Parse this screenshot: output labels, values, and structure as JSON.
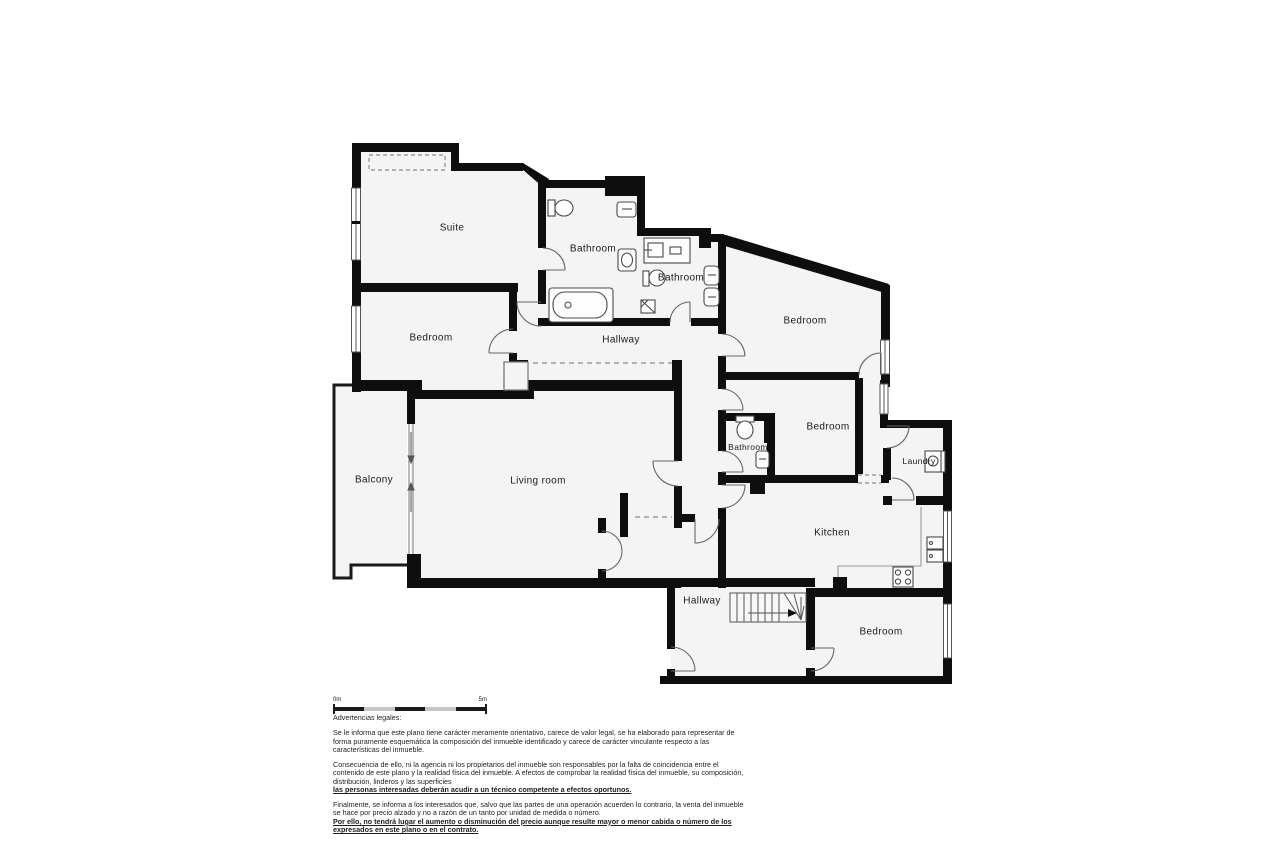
{
  "floorplan": {
    "rooms": [
      {
        "name": "suite",
        "label": "Suite",
        "x": 452,
        "y": 228
      },
      {
        "name": "bathroom-1",
        "label": "Bathroom",
        "x": 593,
        "y": 249
      },
      {
        "name": "bathroom-2",
        "label": "Bathroom",
        "x": 681,
        "y": 278
      },
      {
        "name": "bedroom-top-right",
        "label": "Bedroom",
        "x": 805,
        "y": 321
      },
      {
        "name": "hallway-upper",
        "label": "Hallway",
        "x": 621,
        "y": 340
      },
      {
        "name": "bedroom-left",
        "label": "Bedroom",
        "x": 431,
        "y": 338
      },
      {
        "name": "balcony",
        "label": "Balcony",
        "x": 374,
        "y": 480
      },
      {
        "name": "living-room",
        "label": "Living room",
        "x": 538,
        "y": 481
      },
      {
        "name": "bathroom-3",
        "label": "Bathroom",
        "x": 748,
        "y": 447
      },
      {
        "name": "bedroom-middle",
        "label": "Bedroom",
        "x": 828,
        "y": 427
      },
      {
        "name": "laundry",
        "label": "Laundry",
        "x": 919,
        "y": 461
      },
      {
        "name": "kitchen",
        "label": "Kitchen",
        "x": 832,
        "y": 533
      },
      {
        "name": "hallway-lower",
        "label": "Hallway",
        "x": 702,
        "y": 601
      },
      {
        "name": "bedroom-bottom",
        "label": "Bedroom",
        "x": 881,
        "y": 632
      }
    ],
    "scale_bar": {
      "start_label": "0m",
      "end_label": "5m"
    }
  },
  "legal": {
    "title": "Advertencias legales:",
    "p1": "Se le informa que este plano tiene carácter meramente orientativo, carece de valor legal, se ha elaborado para representar de forma puramente esquemática la composición del inmueble identificado y carece de carácter vinculante respecto a las características del inmueble.",
    "p2_normal": "Consecuencia de ello, ni la agencia ni los propietarios del inmueble son responsables por la falta de coincidencia entre el contenido de este plano y la realidad física del inmueble. A efectos de comprobar la realidad física del inmueble, su composición, distribución, linderos y las superficies",
    "p2_bold": "las personas interesadas deberán acudir a un técnico competente a efectos oportunos.",
    "p3_normal": "Finalmente, se informa a los interesados que, salvo que las partes de una operación acuerden lo contrario, la venta del inmueble se hace por precio alzado y no a razón de un tanto por unidad de medida o número.",
    "p3_bold": "Por ello, no tendrá lugar el aumento o disminución del precio aunque resulte mayor o menor cabida o número de los expresados en este plano o en el contrato."
  }
}
